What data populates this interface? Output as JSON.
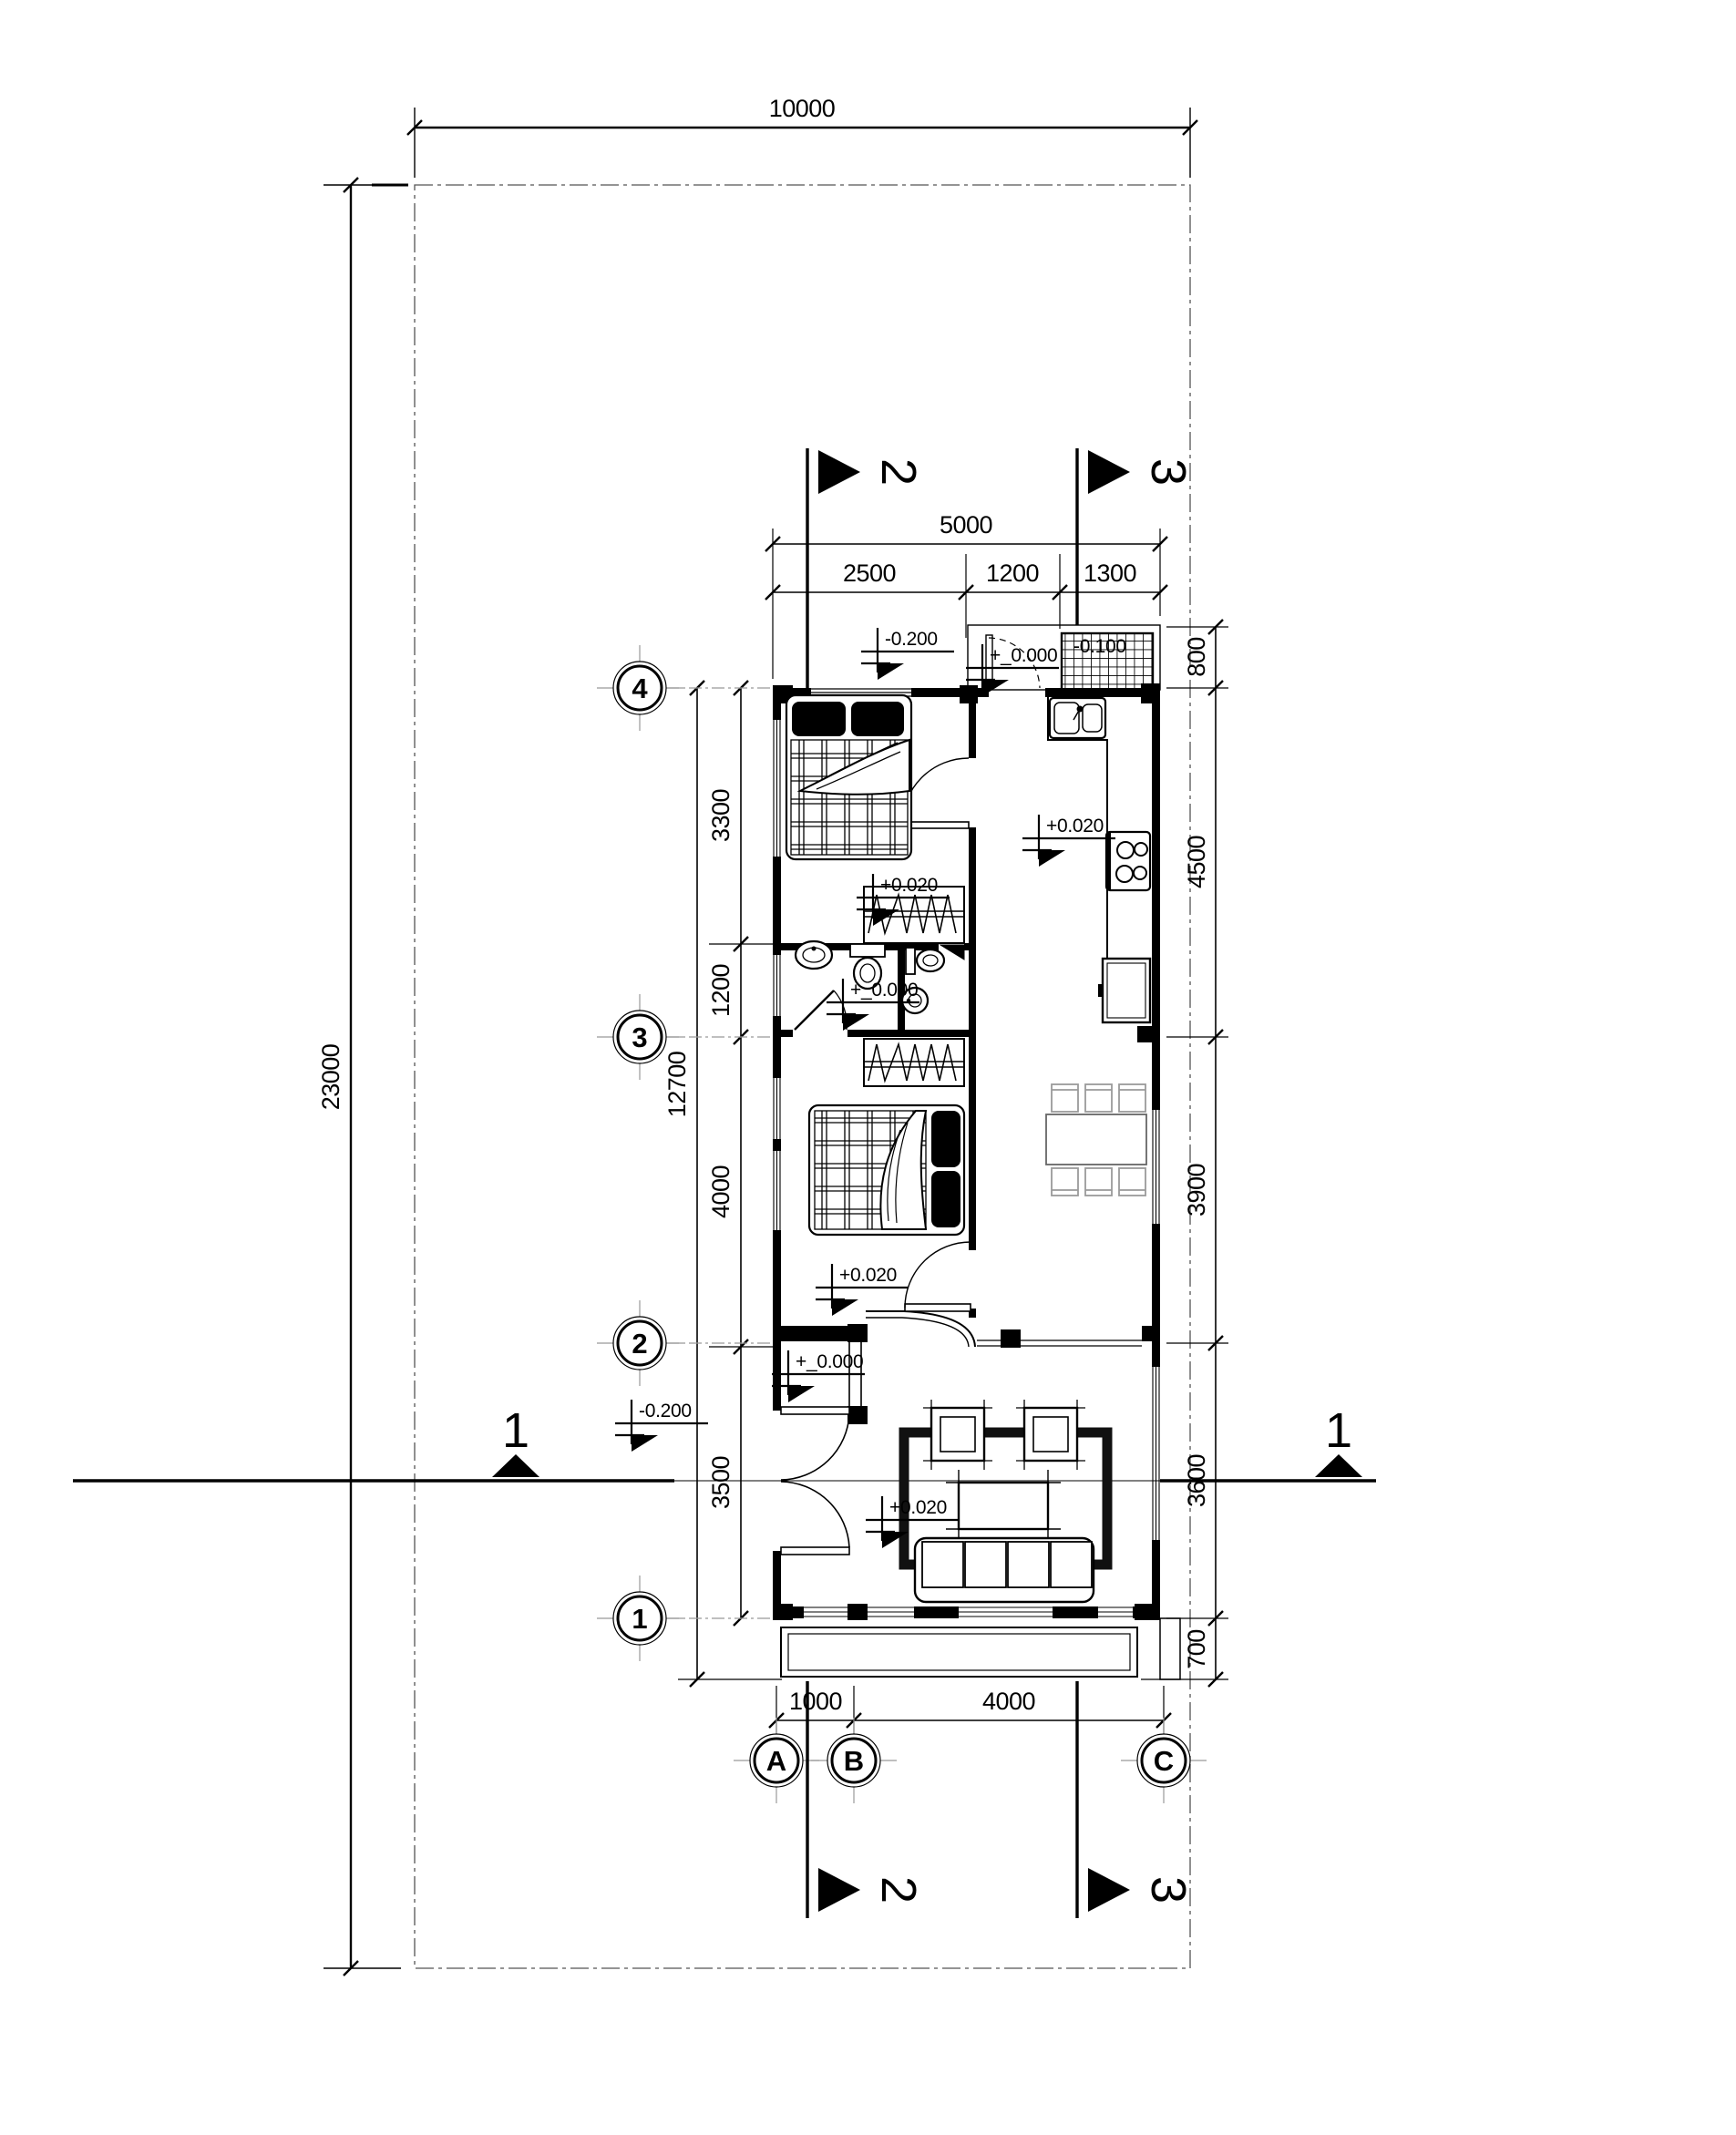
{
  "drawing": {
    "type": "floor-plan",
    "site": {
      "width_label": "10000",
      "depth_label": "23000"
    },
    "dims": {
      "top_total": "5000",
      "top_chain": [
        "2500",
        "1200",
        "1300"
      ],
      "right_chain": [
        "800",
        "4500",
        "3900",
        "3600",
        "700"
      ],
      "left_chain": [
        "3300",
        "1200",
        "4000",
        "3500"
      ],
      "left_total": "12700",
      "bottom_chain": [
        "1000",
        "4000"
      ]
    },
    "grid": {
      "rows": [
        "4",
        "3",
        "2",
        "1"
      ],
      "cols": [
        "A",
        "B",
        "C"
      ]
    },
    "sections": {
      "s1": "1",
      "s2": "2",
      "s3": "3"
    },
    "levels": {
      "front_yard": "-0.200",
      "back_door": "+_0.000",
      "back_porch": "-0.100",
      "kitchen": "+0.020",
      "bedroom1": "+0.020",
      "bath": "+_0.000",
      "bedroom2": "+0.020",
      "vestibule": "+_0.000",
      "entry_yard": "-0.200",
      "living": "+0.020"
    },
    "colors": {
      "ink": "#000000",
      "bg": "#ffffff",
      "muted": "#8a8a8a"
    }
  }
}
